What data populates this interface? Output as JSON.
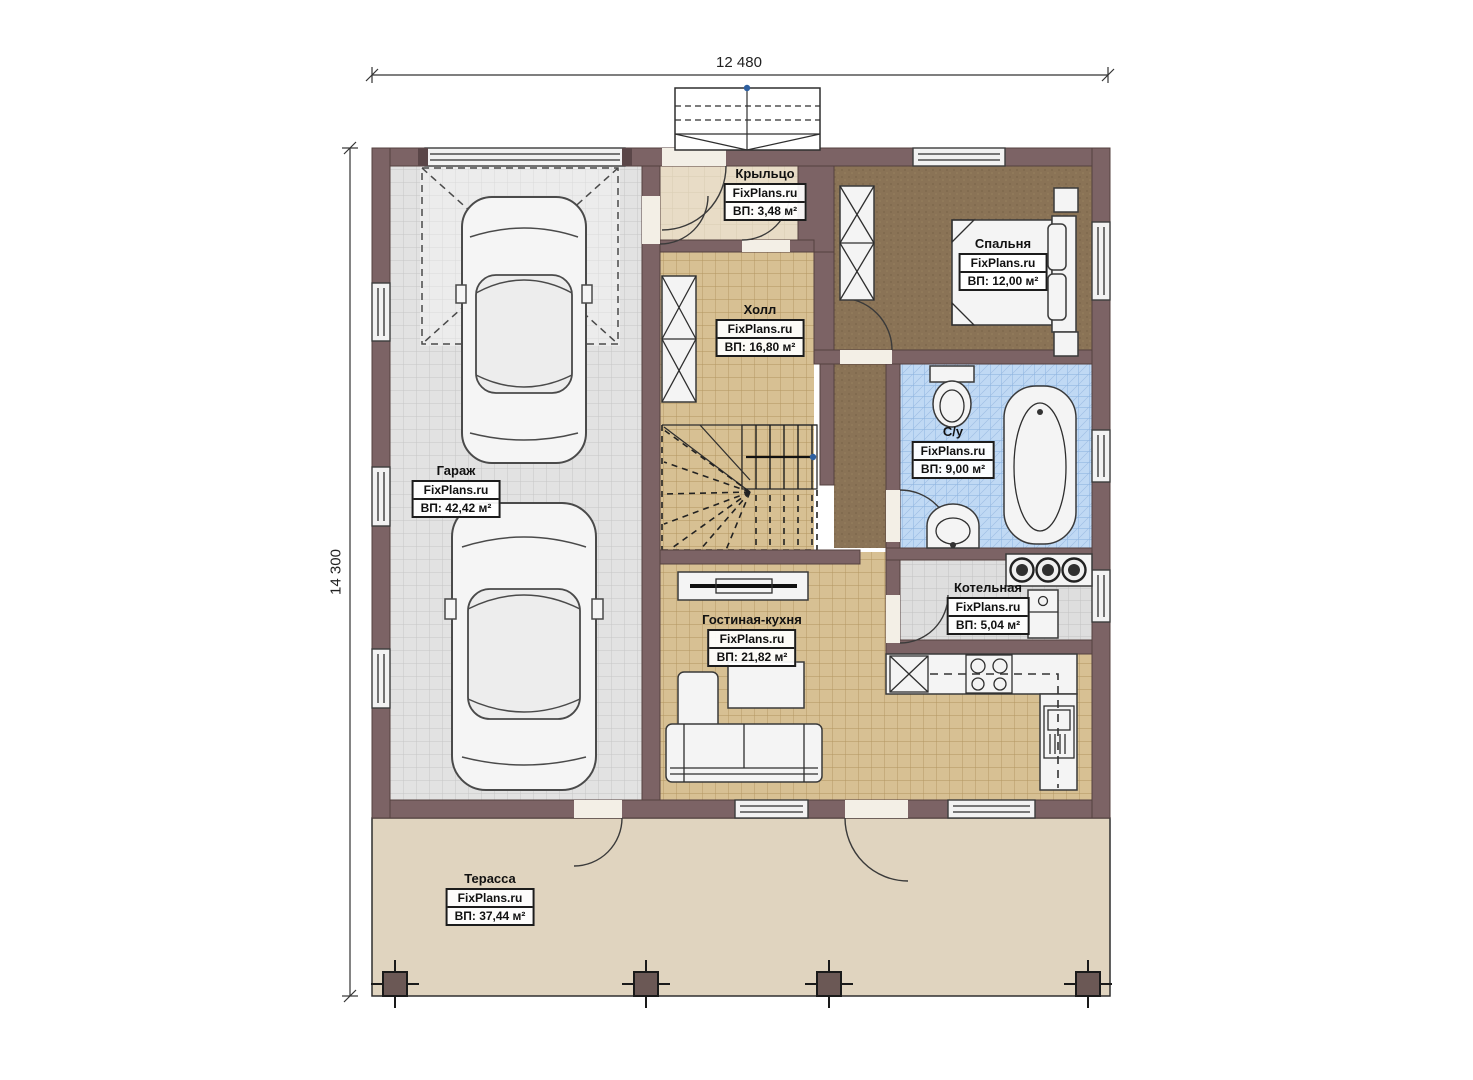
{
  "plan": {
    "dimensions": {
      "width": "12 480",
      "height": "14 300"
    },
    "brand": "FixPlans.ru",
    "rooms": [
      {
        "id": "porch",
        "name": "Крыльцо",
        "brand": "FixPlans.ru",
        "area": "ВП: 3,48 м²"
      },
      {
        "id": "bedroom",
        "name": "Спальня",
        "brand": "FixPlans.ru",
        "area": "ВП: 12,00 м²"
      },
      {
        "id": "hall",
        "name": "Холл",
        "brand": "FixPlans.ru",
        "area": "ВП: 16,80 м²"
      },
      {
        "id": "garage",
        "name": "Гараж",
        "brand": "FixPlans.ru",
        "area": "ВП: 42,42 м²"
      },
      {
        "id": "bathroom",
        "name": "С/у",
        "brand": "FixPlans.ru",
        "area": "ВП: 9,00 м²"
      },
      {
        "id": "boiler",
        "name": "Котельная",
        "brand": "FixPlans.ru",
        "area": "ВП: 5,04 м²"
      },
      {
        "id": "living",
        "name": "Гостиная-кухня",
        "brand": "FixPlans.ru",
        "area": "ВП: 21,82 м²"
      },
      {
        "id": "terrace",
        "name": "Терасса",
        "brand": "FixPlans.ru",
        "area": "ВП: 37,44 м²"
      }
    ],
    "colors": {
      "wall": "#7c6365",
      "garage_floor": "#e2e2e2",
      "wood_floor": "#d7c093",
      "carpet": "#8a7356",
      "bath_tile": "#c0d9f4",
      "boiler_floor": "#dedede",
      "porch_floor": "#e8dcc6",
      "terrace": "#e0d4bf",
      "marker_blue": "#2e5f9f"
    }
  }
}
